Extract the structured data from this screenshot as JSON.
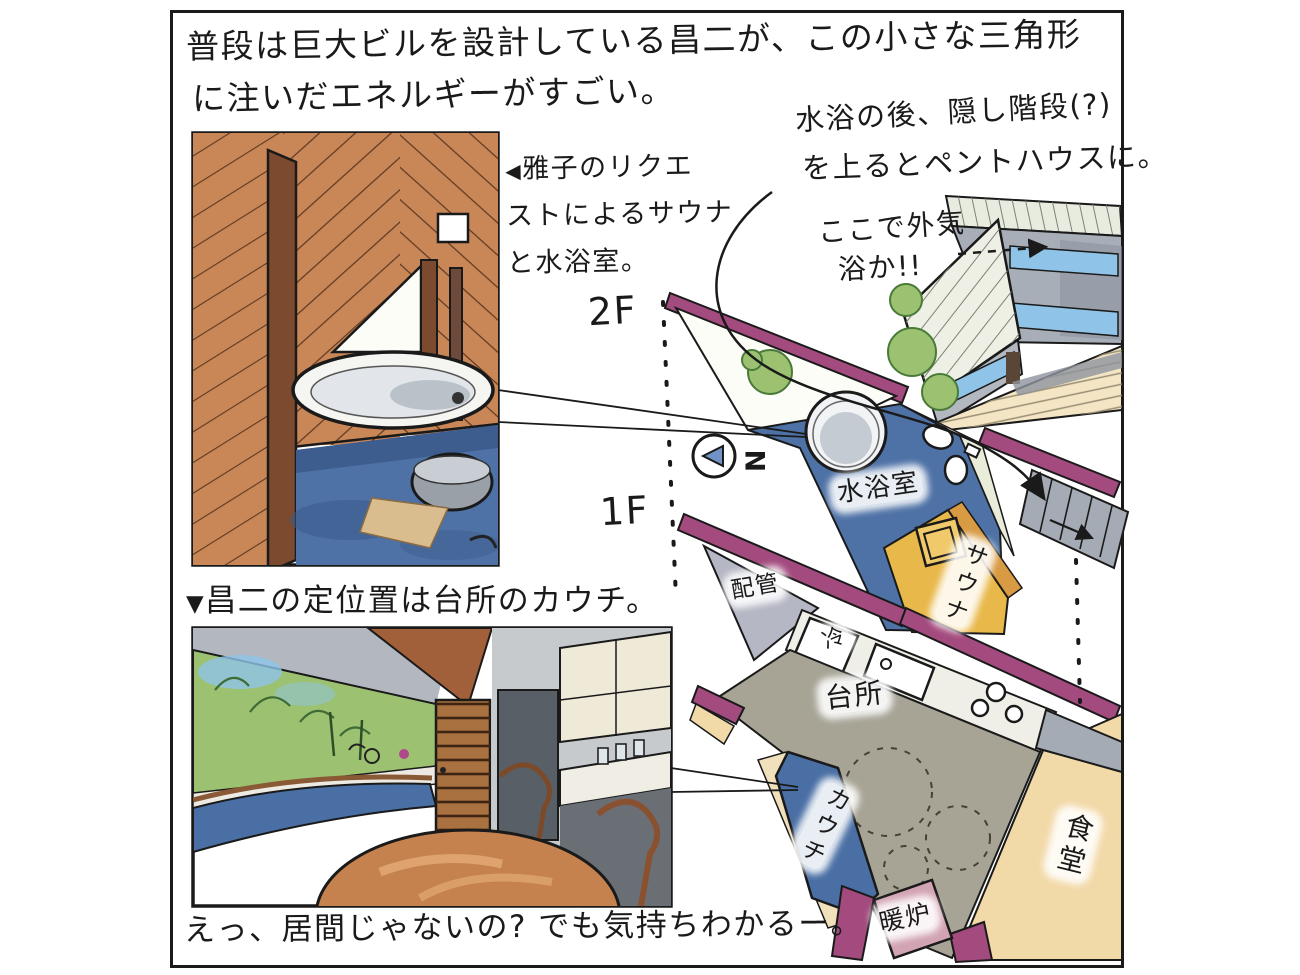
{
  "captions": {
    "top": {
      "line1": "普段は巨大ビルを設計している昌二が、この小さな三角形",
      "line2": "に注いだエネルギーがすごい。"
    },
    "bottom": "えっ、居間じゃないの? でも気持ちわかるー。"
  },
  "notes": {
    "penthouse": {
      "line1": "水浴の後、隠し階段(?)",
      "line2": "を上るとペントハウスに。"
    },
    "air_bath": {
      "line1": "ここで外気",
      "line2": "浴か!!"
    },
    "sauna_request": {
      "marker": "◀",
      "line1": "雅子のリクエ",
      "line2": "ストによるサウナ",
      "line3": "と水浴室。"
    },
    "couch_position": {
      "marker": "▼",
      "text": "昌二の定位置は台所のカウチ。"
    }
  },
  "floor_labels": {
    "second": "2F",
    "first": "1F"
  },
  "compass": {
    "letter": "N"
  },
  "plan_2f": {
    "water_bath_room": "水浴室",
    "sauna": "サウナ"
  },
  "plan_1f": {
    "piping": "配管",
    "fridge": "冷",
    "kitchen": "台所",
    "couch": "カウチ",
    "dining": "食堂",
    "fireplace": "暖炉"
  },
  "colors": {
    "wall_purple": "#a34b7e",
    "water_blue": "#4e72a6",
    "sauna_yellow": "#e9b84a",
    "sauna_wall_orange": "#d89a42",
    "kitchen_gray": "#a7a496",
    "dining_cream": "#f2d9a8",
    "fireplace_pink": "#d2a3b2",
    "piping_gray": "#b5b7c4",
    "wood_orange": "#c98757",
    "door_brown": "#a9713f",
    "foliage_green": "#9cc271",
    "couch_blue": "#4a6fa5",
    "stairs_gray": "#a5abb5",
    "sky_blue": "#8fc4e8",
    "ink": "#1a1a1a"
  }
}
